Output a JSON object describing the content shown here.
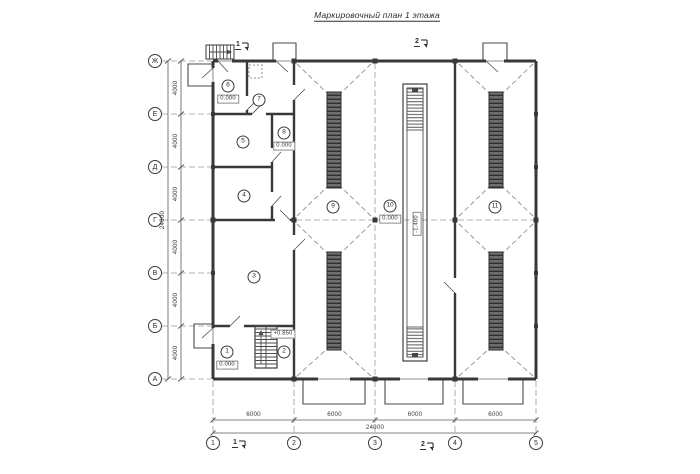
{
  "title": "Маркировочный план 1 этажа",
  "axes": {
    "rows": [
      {
        "label": "Ж"
      },
      {
        "label": "Е"
      },
      {
        "label": "Д"
      },
      {
        "label": "Г"
      },
      {
        "label": "В"
      },
      {
        "label": "Б"
      },
      {
        "label": "А"
      }
    ],
    "cols": [
      {
        "label": "1"
      },
      {
        "label": "2"
      },
      {
        "label": "3"
      },
      {
        "label": "4"
      },
      {
        "label": "5"
      }
    ]
  },
  "dimensions": {
    "left_segments": [
      "4000",
      "4000",
      "4000",
      "4000",
      "4000",
      "4000"
    ],
    "left_total": "24000",
    "bottom_segments": [
      "6000",
      "6000",
      "6000",
      "6000"
    ],
    "bottom_total": "24000"
  },
  "rooms": [
    {
      "num": "1",
      "elevation": "0.000"
    },
    {
      "num": "2",
      "elevation": "+0.850"
    },
    {
      "num": "3"
    },
    {
      "num": "4"
    },
    {
      "num": "5"
    },
    {
      "num": "6",
      "elevation": "0.000"
    },
    {
      "num": "7"
    },
    {
      "num": "8",
      "elevation": "0.000"
    },
    {
      "num": "9"
    },
    {
      "num": "10",
      "elevation": "0.000"
    },
    {
      "num": "11"
    }
  ],
  "pit": {
    "elevation": "-1.400"
  },
  "section_marks": {
    "top_left": "1",
    "top_right": "2",
    "bottom_left": "1",
    "bottom_right": "2"
  },
  "colors": {
    "line": "#383838",
    "axis_dash": "#9a9a9a",
    "grating_fill": "#6e6e6e",
    "background": "#ffffff"
  }
}
